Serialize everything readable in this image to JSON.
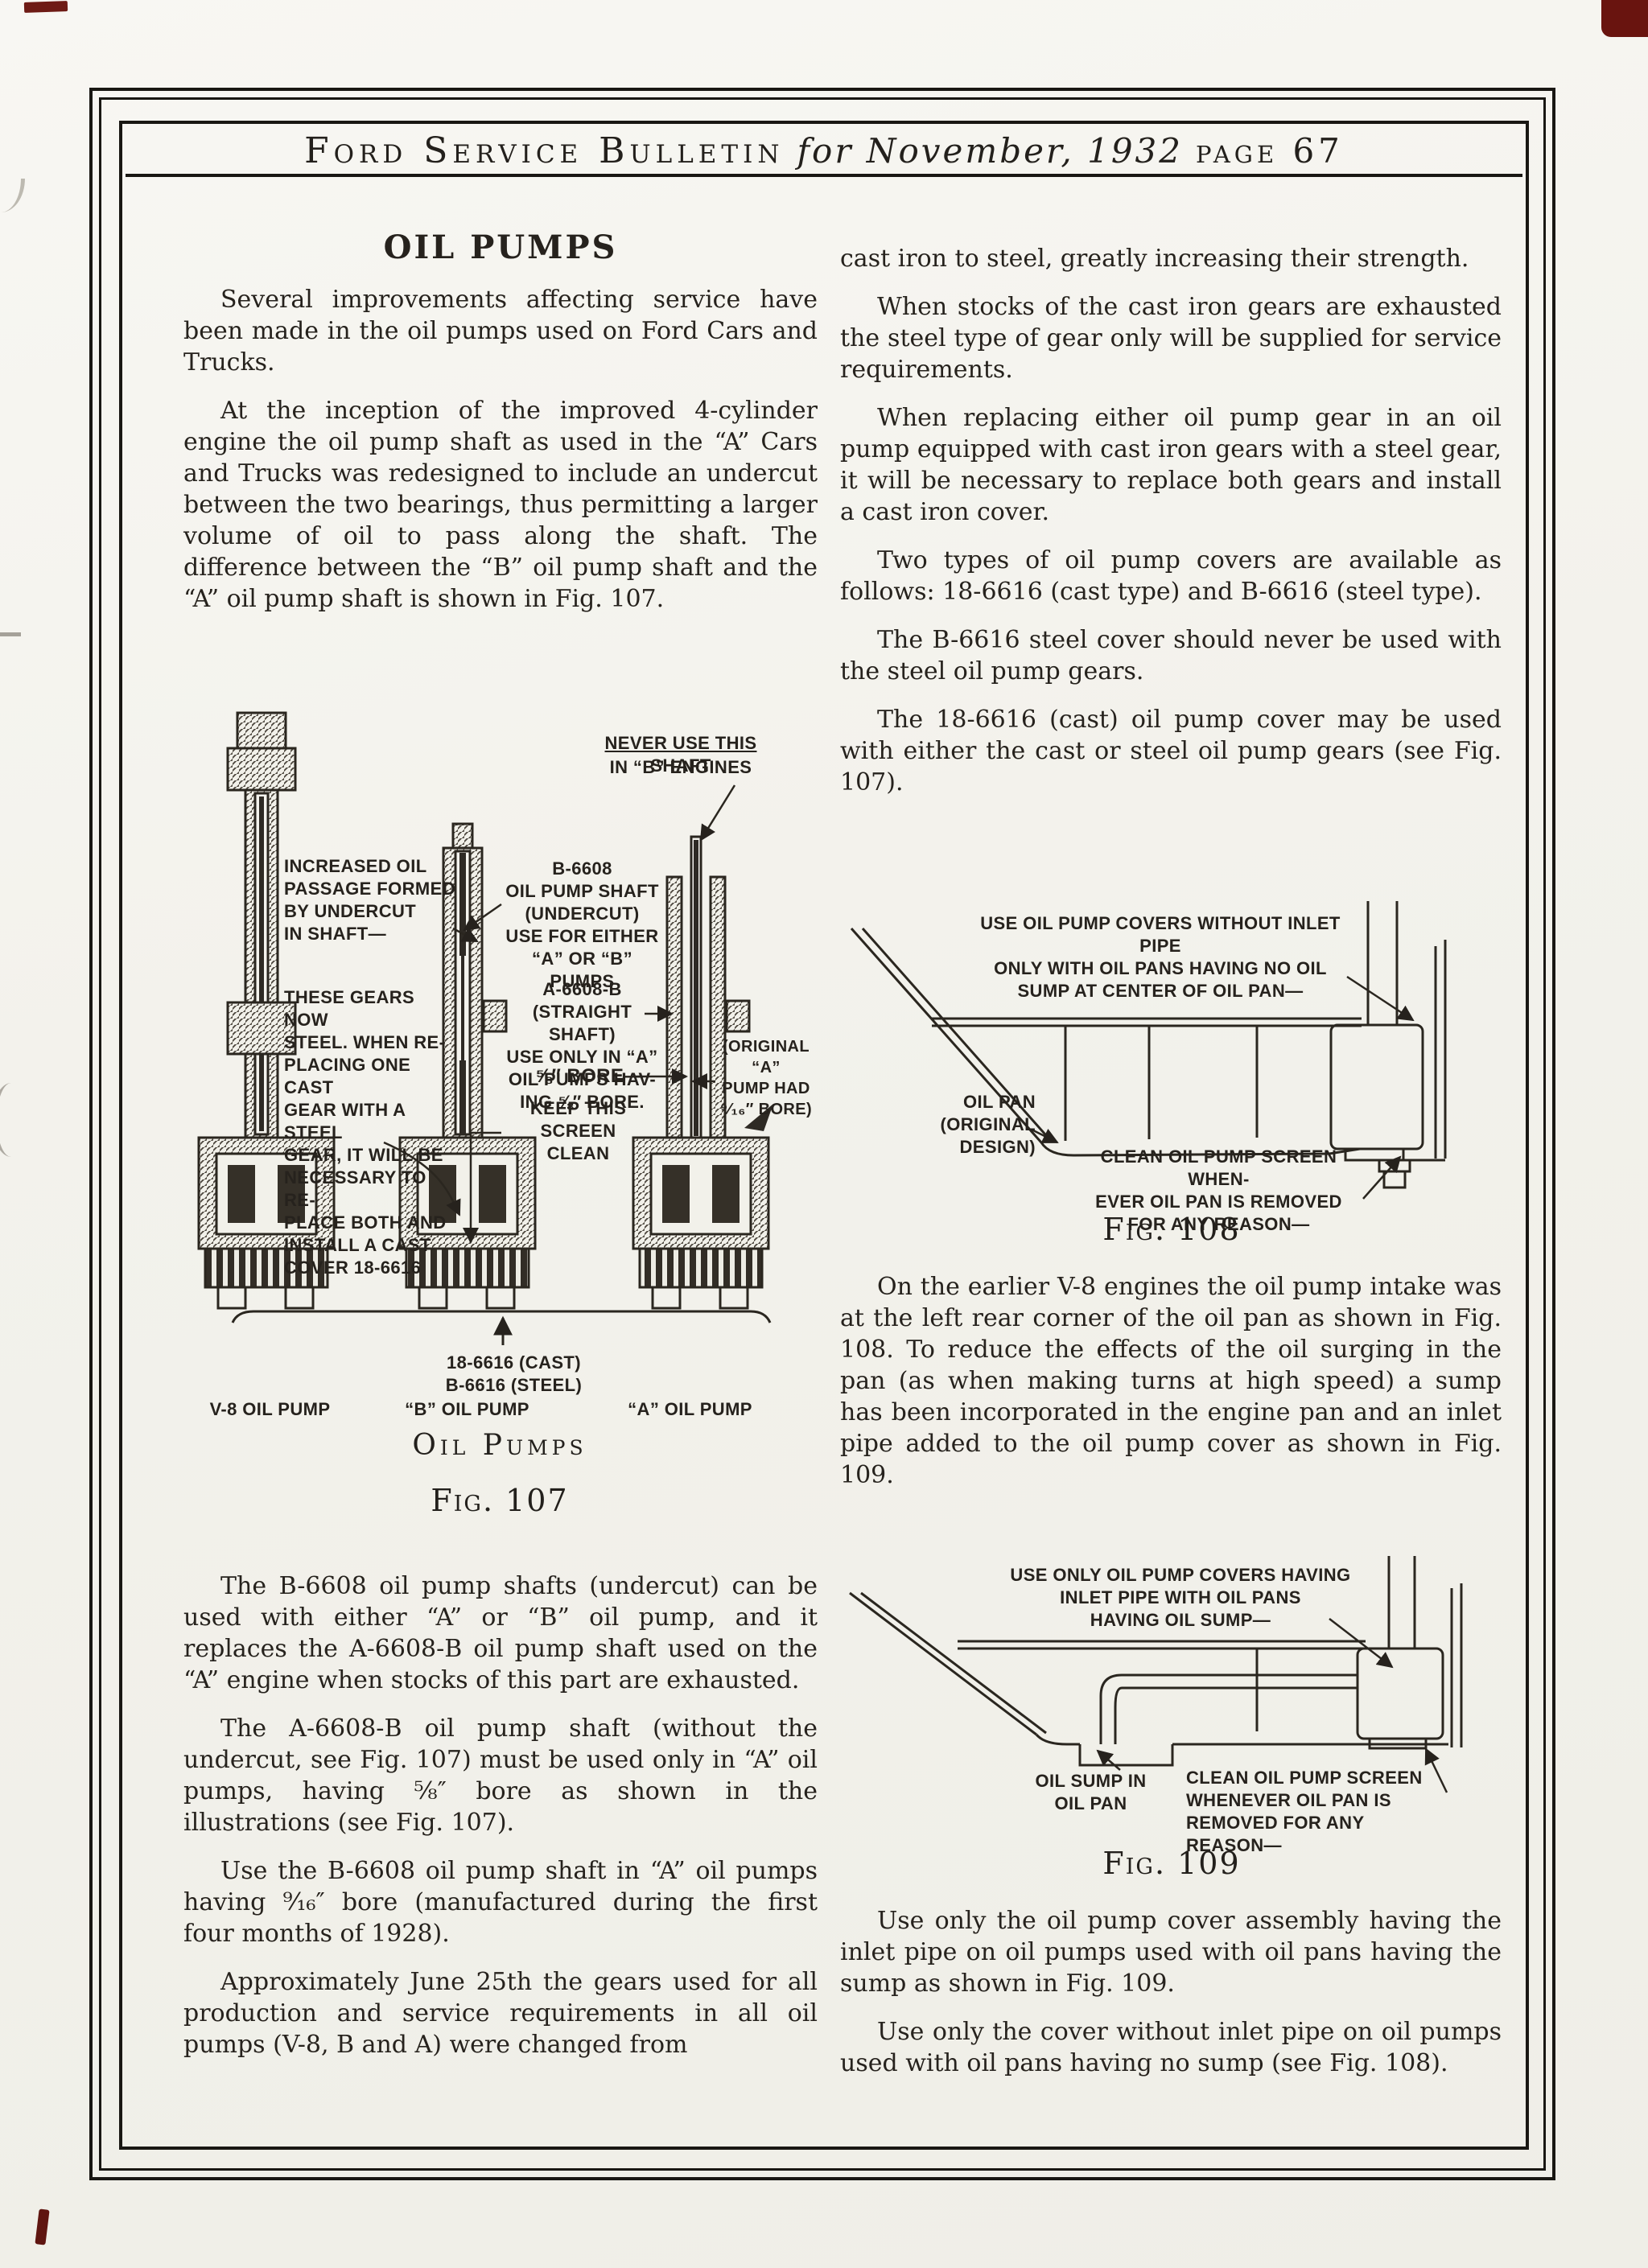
{
  "header": {
    "bulletin": "Ford Service Bulletin",
    "issue": "for November, 1932",
    "page": "page 67"
  },
  "colors": {
    "paper": "#f2f1ea",
    "ink": "#23201c",
    "frame": "#191713",
    "stamp_red": "#6e1b15"
  },
  "left_column": {
    "heading": "OIL PUMPS",
    "paras_top": [
      "Several improvements affecting service have been made in the oil pumps used on Ford Cars and Trucks.",
      "At the inception of the improved 4-cylinder engine the oil pump shaft as used in the “A” Cars and Trucks was redesigned to include an undercut between the two bearings, thus permitting a larger volume of oil to pass along the shaft. The difference between the “B” oil pump shaft and the “A” oil pump shaft is shown in Fig. 107."
    ],
    "fig107": {
      "label_never_1": "NEVER USE THIS SHAFT",
      "label_never_2": "IN “B” ENGINES",
      "label_increased": "INCREASED OIL\nPASSAGE FORMED\nBY UNDERCUT\nIN SHAFT—",
      "label_b6608": "B-6608\nOIL PUMP SHAFT\n(UNDERCUT)\nUSE FOR EITHER\n“A” OR “B” PUMPS",
      "label_gears": "THESE GEARS NOW\nSTEEL. WHEN RE-\nPLACING ONE CAST\nGEAR WITH A STEEL\nGEAR, IT WILL BE\nNECESSARY TO RE-\nPLACE BOTH AND\nINSTALL A CAST\nCOVER 18-6616",
      "label_a6608": "A-6608-B\n(STRAIGHT SHAFT)\nUSE ONLY IN “A”\nOIL PUMPS HAV-\nING ⅝″ BORE.",
      "label_bore": "⅝″ BORE—",
      "label_screen": "KEEP THIS SCREEN\nCLEAN",
      "label_original": "(ORIGINAL “A”\nPUMP HAD\n⁹⁄₁₆″ BORE)",
      "label_covers": "18-6616 (CAST)\nB-6616 (STEEL)",
      "label_pump_v8": "V-8 OIL PUMP",
      "label_pump_b": "“B” OIL PUMP",
      "label_pump_a": "“A” OIL PUMP",
      "caption_title": "Oil Pumps",
      "caption": "Fig. 107"
    },
    "paras_bottom": [
      "The B-6608 oil pump shafts (undercut) can be used with either “A” or “B” oil pump, and it replaces the A-6608-B oil pump shaft used on the “A” engine when stocks of this part are exhausted.",
      "The A-6608-B oil pump shaft (without the undercut, see Fig. 107) must be used only in “A” oil pumps, having ⅝″ bore as shown in the illustrations (see Fig. 107).",
      "Use the B-6608 oil pump shaft in “A” oil pumps having ⁹⁄₁₆″ bore (manufactured during the first four months of 1928).",
      "Approximately June 25th the gears used for all production and service requirements in all oil pumps (V-8, B and A) were changed from"
    ]
  },
  "right_column": {
    "paras_top": [
      "cast iron to steel, greatly increasing their strength.",
      "When stocks of the cast iron gears are exhausted the steel type of gear only will be supplied for service requirements.",
      "When replacing either oil pump gear in an oil pump equipped with cast iron gears with a steel gear, it will be necessary to replace both gears and install a cast iron cover.",
      "Two types of oil pump covers are available as follows: 18-6616 (cast type) and B-6616 (steel type).",
      "The B-6616 steel cover should never be used with the steel oil pump gears.",
      "The 18-6616 (cast) oil pump cover may be used with either the cast or steel oil pump gears (see Fig. 107)."
    ],
    "fig108": {
      "label_top": "USE OIL PUMP COVERS WITHOUT INLET PIPE\nONLY WITH OIL PANS HAVING NO OIL\nSUMP AT CENTER OF OIL PAN—",
      "label_oil_pan": "OIL PAN\n(ORIGINAL DESIGN)",
      "label_clean": "CLEAN OIL PUMP SCREEN WHEN-\nEVER OIL PAN IS REMOVED\nFOR ANY REASON—",
      "caption": "Fig. 108"
    },
    "para_mid": "On the earlier V-8 engines the oil pump intake was at the left rear corner of the oil pan as shown in Fig. 108. To reduce the effects of the oil surging in the pan (as when making turns at high speed) a sump has been incorporated in the engine pan and an inlet pipe added to the oil pump cover as shown in Fig. 109.",
    "fig109": {
      "label_top": "USE ONLY OIL PUMP COVERS HAVING\nINLET PIPE WITH OIL PANS\nHAVING OIL SUMP—",
      "label_sump": "OIL SUMP IN\nOIL PAN",
      "label_clean": "CLEAN OIL PUMP SCREEN\nWHENEVER OIL PAN IS\nREMOVED FOR ANY REASON—",
      "caption": "Fig. 109"
    },
    "paras_bottom": [
      "Use only the oil pump cover assembly having the inlet pipe on oil pumps used with oil pans having the sump as shown in Fig. 109.",
      "Use only the cover without inlet pipe on oil pumps used with oil pans having no sump (see Fig. 108)."
    ]
  }
}
